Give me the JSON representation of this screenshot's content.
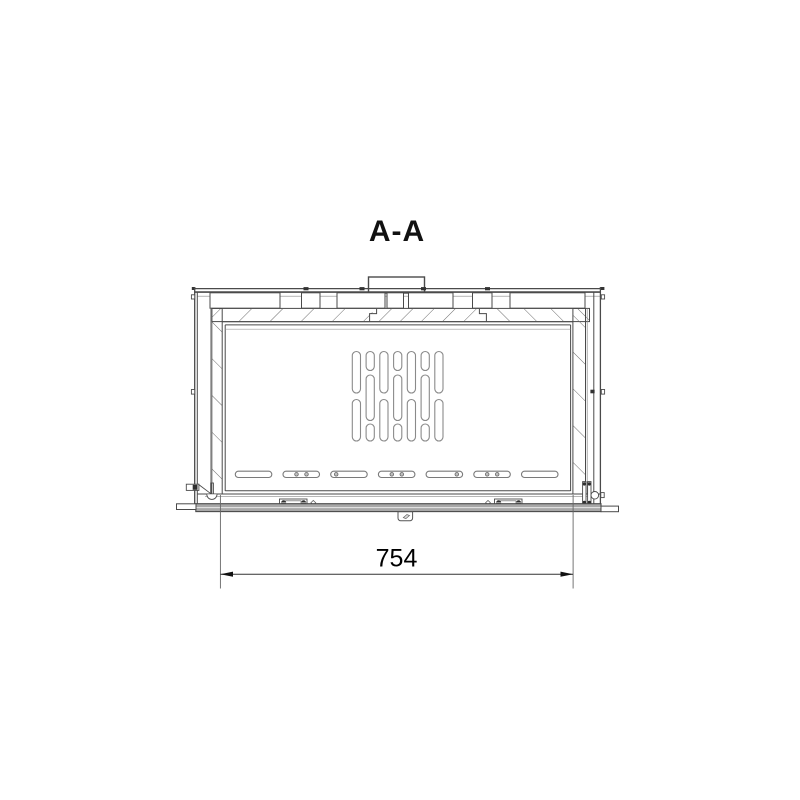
{
  "title": "A-A",
  "dimension": {
    "value": "754"
  },
  "drawing_info": {
    "type": "technical-cross-section",
    "vertical_vent_columns": 7,
    "horizontal_vent_slots": 7
  },
  "colors": {
    "line_dark": "#4a4a4a",
    "hatch": "#6e6e6e",
    "slot_outline": "#8a8a8a",
    "rail_fill": "#a8a8a8",
    "text": "#000000"
  }
}
